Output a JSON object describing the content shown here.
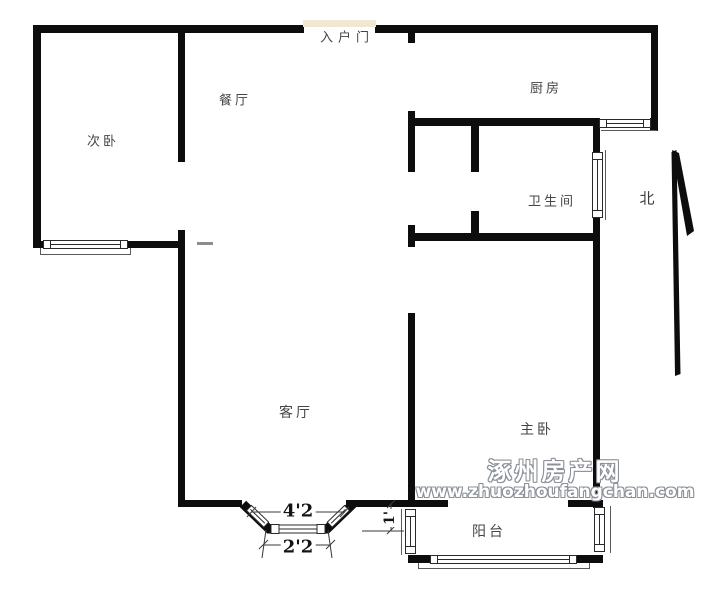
{
  "floorplan": {
    "rooms": {
      "entry_door": "入户门",
      "dining": "餐厅",
      "bedroom2": "次卧",
      "kitchen": "厨房",
      "bathroom": "卫生间",
      "living": "客厅",
      "master_bedroom": "主卧",
      "balcony": "阳台"
    },
    "compass": {
      "north": "北"
    },
    "dimensions": {
      "bay_window_outer": "4'2",
      "bay_window_inner": "2'2",
      "balcony_side": "1'"
    },
    "colors": {
      "wall": "#0d0d0d",
      "entry_door_marker": "#efe9d3",
      "room_label": "#454545",
      "watermark_fill": "#ffffff",
      "watermark_outline": "#8b9099"
    }
  },
  "watermark": {
    "site_name": "涿州房产网",
    "site_url": "www.zhuozhoufangchan.com"
  }
}
